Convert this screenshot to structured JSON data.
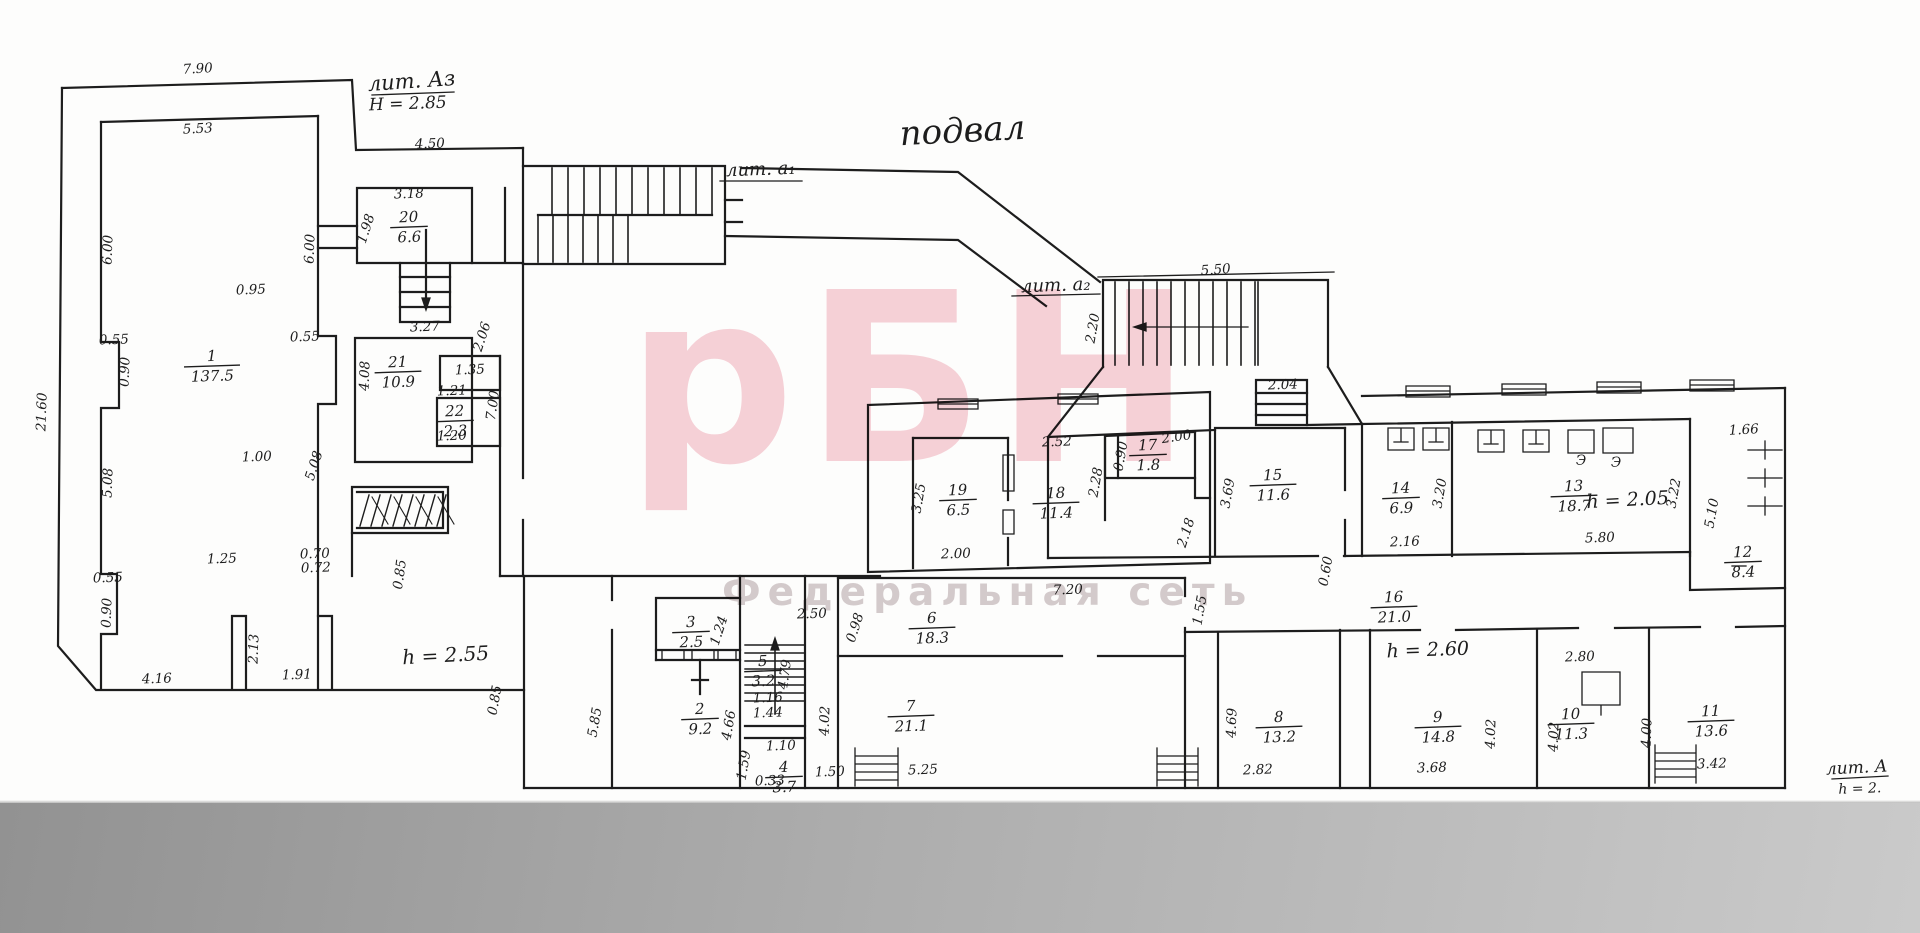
{
  "title": "подвал",
  "watermark": {
    "logo": "рБН",
    "subtitle": "Федеральная сеть",
    "logo_color": "#f2b4c0",
    "subtitle_color": "#b2a2a6"
  },
  "colors": {
    "ink": "#1d1d1d",
    "paper": "#fdfdfc",
    "scan_band_dark": "#929292",
    "scan_band_light": "#cacaca"
  },
  "annotations": [
    {
      "t": "подвал",
      "x": 963,
      "y": 142,
      "s": 34,
      "r": -3,
      "name": "plan-title"
    },
    {
      "t": "лит. Аз",
      "x": 412,
      "y": 88,
      "s": 21,
      "r": -4,
      "u": 86,
      "name": "liter-A3-label"
    },
    {
      "t": "H = 2.85",
      "x": 408,
      "y": 109,
      "s": 17,
      "r": -2,
      "name": "height-A3-label"
    },
    {
      "t": "лит. а₁",
      "x": 761,
      "y": 175,
      "s": 18,
      "r": -2,
      "u": 84,
      "name": "liter-a1-label"
    },
    {
      "t": "лит. а₂",
      "x": 1056,
      "y": 291,
      "s": 18,
      "r": -2,
      "u": 90,
      "name": "liter-a2-label"
    },
    {
      "t": "h = 2.55",
      "x": 446,
      "y": 662,
      "s": 20,
      "r": -3,
      "name": "height-note"
    },
    {
      "t": "h = 2.60",
      "x": 1428,
      "y": 656,
      "s": 19,
      "r": -2,
      "name": "height-note"
    },
    {
      "t": "h = 2.05",
      "x": 1628,
      "y": 506,
      "s": 19,
      "r": -3,
      "name": "height-note"
    },
    {
      "t": "лит. А",
      "x": 1857,
      "y": 773,
      "s": 17,
      "r": -3,
      "u": 60,
      "name": "liter-A-label"
    },
    {
      "t": "h = 2.",
      "x": 1860,
      "y": 793,
      "s": 14,
      "r": -2,
      "name": "height-note"
    }
  ],
  "rooms": [
    {
      "num": "1",
      "area": "137.5",
      "x": 212,
      "y": 366
    },
    {
      "num": "20",
      "area": "6.6",
      "x": 409,
      "y": 227
    },
    {
      "num": "21",
      "area": "10.9",
      "x": 398,
      "y": 372
    },
    {
      "num": "22",
      "area": "2.3",
      "x": 455,
      "y": 421
    },
    {
      "num": "19",
      "area": "6.5",
      "x": 958,
      "y": 500
    },
    {
      "num": "18",
      "area": "11.4",
      "x": 1056,
      "y": 503
    },
    {
      "num": "17",
      "area": "1.8",
      "x": 1148,
      "y": 455
    },
    {
      "num": "15",
      "area": "11.6",
      "x": 1273,
      "y": 485
    },
    {
      "num": "14",
      "area": "6.9",
      "x": 1401,
      "y": 498
    },
    {
      "num": "13",
      "area": "18.7",
      "x": 1574,
      "y": 496
    },
    {
      "num": "12",
      "area": "8.4",
      "x": 1743,
      "y": 562
    },
    {
      "num": "16",
      "area": "21.0",
      "x": 1394,
      "y": 607
    },
    {
      "num": "3",
      "area": "2.5",
      "x": 691,
      "y": 632
    },
    {
      "num": "2",
      "area": "9.2",
      "x": 700,
      "y": 719
    },
    {
      "num": "5",
      "area": "3.2",
      "x": 763,
      "y": 671
    },
    {
      "num": "4",
      "area": "3.7",
      "x": 784,
      "y": 777
    },
    {
      "num": "6",
      "area": "18.3",
      "x": 932,
      "y": 628
    },
    {
      "num": "7",
      "area": "21.1",
      "x": 911,
      "y": 716
    },
    {
      "num": "8",
      "area": "13.2",
      "x": 1279,
      "y": 727
    },
    {
      "num": "9",
      "area": "14.8",
      "x": 1438,
      "y": 727
    },
    {
      "num": "10",
      "area": "11.3",
      "x": 1571,
      "y": 724
    },
    {
      "num": "11",
      "area": "13.6",
      "x": 1711,
      "y": 721
    }
  ],
  "dimensions": [
    {
      "t": "7.90",
      "x": 198,
      "y": 73,
      "r": -3
    },
    {
      "t": "5.53",
      "x": 198,
      "y": 133,
      "r": -3
    },
    {
      "t": "4.50",
      "x": 430,
      "y": 148,
      "r": -2
    },
    {
      "t": "3.18",
      "x": 409,
      "y": 198,
      "r": -2
    },
    {
      "t": "1.98",
      "x": 370,
      "y": 230,
      "r": -72
    },
    {
      "t": "6.00",
      "x": 112,
      "y": 250,
      "r": -88
    },
    {
      "t": "6.00",
      "x": 314,
      "y": 249,
      "r": -88
    },
    {
      "t": "0.95",
      "x": 251,
      "y": 294,
      "r": -2
    },
    {
      "t": "3.27",
      "x": 425,
      "y": 331,
      "r": -2
    },
    {
      "t": "0.55",
      "x": 114,
      "y": 344,
      "r": -2
    },
    {
      "t": "0.90",
      "x": 129,
      "y": 372,
      "r": -88
    },
    {
      "t": "0.55",
      "x": 305,
      "y": 341,
      "r": -2
    },
    {
      "t": "4.08",
      "x": 369,
      "y": 376,
      "r": -88
    },
    {
      "t": "2.06",
      "x": 486,
      "y": 338,
      "r": -72
    },
    {
      "t": "1.35",
      "x": 470,
      "y": 374,
      "r": -2
    },
    {
      "t": "1.21",
      "x": 452,
      "y": 395,
      "r": -2
    },
    {
      "t": "1.20",
      "x": 452,
      "y": 440,
      "r": -2
    },
    {
      "t": "21.60",
      "x": 46,
      "y": 412,
      "r": -88
    },
    {
      "t": "5.08",
      "x": 112,
      "y": 483,
      "r": -88
    },
    {
      "t": "5.08",
      "x": 318,
      "y": 467,
      "r": -72
    },
    {
      "t": "1.00",
      "x": 257,
      "y": 461,
      "r": -2
    },
    {
      "t": "7.00",
      "x": 497,
      "y": 406,
      "r": -82
    },
    {
      "t": "0.55",
      "x": 108,
      "y": 582,
      "r": -2
    },
    {
      "t": "0.90",
      "x": 111,
      "y": 613,
      "r": -88
    },
    {
      "t": "1.25",
      "x": 222,
      "y": 563,
      "r": -2
    },
    {
      "t": "0.70",
      "x": 315,
      "y": 558,
      "r": -2
    },
    {
      "t": "0.72",
      "x": 316,
      "y": 572,
      "r": -2
    },
    {
      "t": "0.85",
      "x": 404,
      "y": 575,
      "r": -82
    },
    {
      "t": "2.13",
      "x": 258,
      "y": 649,
      "r": -88
    },
    {
      "t": "1.91",
      "x": 297,
      "y": 679,
      "r": -2
    },
    {
      "t": "4.16",
      "x": 157,
      "y": 683,
      "r": -2
    },
    {
      "t": "5.50",
      "x": 1216,
      "y": 274,
      "r": -4
    },
    {
      "t": "2.20",
      "x": 1097,
      "y": 329,
      "r": -80
    },
    {
      "t": "2.04",
      "x": 1283,
      "y": 389,
      "r": -2
    },
    {
      "t": "2.52",
      "x": 1057,
      "y": 446,
      "r": -2
    },
    {
      "t": "3.25",
      "x": 923,
      "y": 499,
      "r": -80
    },
    {
      "t": "2.00",
      "x": 956,
      "y": 558,
      "r": -2
    },
    {
      "t": "2.28",
      "x": 1100,
      "y": 483,
      "r": -80
    },
    {
      "t": "0.90",
      "x": 1125,
      "y": 457,
      "r": -80
    },
    {
      "t": "2.00",
      "x": 1177,
      "y": 441,
      "r": -8
    },
    {
      "t": "3.69",
      "x": 1232,
      "y": 494,
      "r": -80
    },
    {
      "t": "2.18",
      "x": 1190,
      "y": 534,
      "r": -72
    },
    {
      "t": "3.20",
      "x": 1444,
      "y": 494,
      "r": -80
    },
    {
      "t": "2.16",
      "x": 1405,
      "y": 546,
      "r": -2
    },
    {
      "t": "5.80",
      "x": 1600,
      "y": 542,
      "r": -2
    },
    {
      "t": "3.22",
      "x": 1678,
      "y": 494,
      "r": -80
    },
    {
      "t": "5.10",
      "x": 1716,
      "y": 514,
      "r": -80
    },
    {
      "t": "1.66",
      "x": 1744,
      "y": 434,
      "r": -3
    },
    {
      "t": "0.60",
      "x": 1330,
      "y": 572,
      "r": -80
    },
    {
      "t": "1.55",
      "x": 1204,
      "y": 611,
      "r": -80
    },
    {
      "t": "7.20",
      "x": 1068,
      "y": 594,
      "r": -2
    },
    {
      "t": "2.50",
      "x": 812,
      "y": 618,
      "r": -2
    },
    {
      "t": "0.98",
      "x": 859,
      "y": 629,
      "r": -72
    },
    {
      "t": "1.24",
      "x": 723,
      "y": 632,
      "r": -72
    },
    {
      "t": "4.79",
      "x": 789,
      "y": 675,
      "r": -82
    },
    {
      "t": "4.02",
      "x": 829,
      "y": 721,
      "r": -88
    },
    {
      "t": "5.85",
      "x": 599,
      "y": 723,
      "r": -80
    },
    {
      "t": "4.66",
      "x": 733,
      "y": 726,
      "r": -80
    },
    {
      "t": "0.85",
      "x": 499,
      "y": 701,
      "r": -80
    },
    {
      "t": "1.10",
      "x": 781,
      "y": 750,
      "r": -2
    },
    {
      "t": "1.16",
      "x": 768,
      "y": 702,
      "r": -2
    },
    {
      "t": "1.44",
      "x": 768,
      "y": 717,
      "r": -2
    },
    {
      "t": "1.59",
      "x": 748,
      "y": 766,
      "r": -80
    },
    {
      "t": "0.33",
      "x": 770,
      "y": 785,
      "r": -2
    },
    {
      "t": "1.50",
      "x": 830,
      "y": 776,
      "r": -2
    },
    {
      "t": "5.25",
      "x": 923,
      "y": 774,
      "r": -2
    },
    {
      "t": "2.82",
      "x": 1258,
      "y": 774,
      "r": -2
    },
    {
      "t": "4.69",
      "x": 1236,
      "y": 723,
      "r": -88
    },
    {
      "t": "3.68",
      "x": 1432,
      "y": 772,
      "r": -2
    },
    {
      "t": "4.02",
      "x": 1495,
      "y": 734,
      "r": -88
    },
    {
      "t": "2.80",
      "x": 1580,
      "y": 661,
      "r": -2
    },
    {
      "t": "4.02",
      "x": 1558,
      "y": 737,
      "r": -88
    },
    {
      "t": "4.00",
      "x": 1651,
      "y": 733,
      "r": -88
    },
    {
      "t": "3.42",
      "x": 1712,
      "y": 768,
      "r": -2
    },
    {
      "t": "Э",
      "x": 1581,
      "y": 465,
      "r": 0
    },
    {
      "t": "Э",
      "x": 1616,
      "y": 467,
      "r": 0
    }
  ]
}
